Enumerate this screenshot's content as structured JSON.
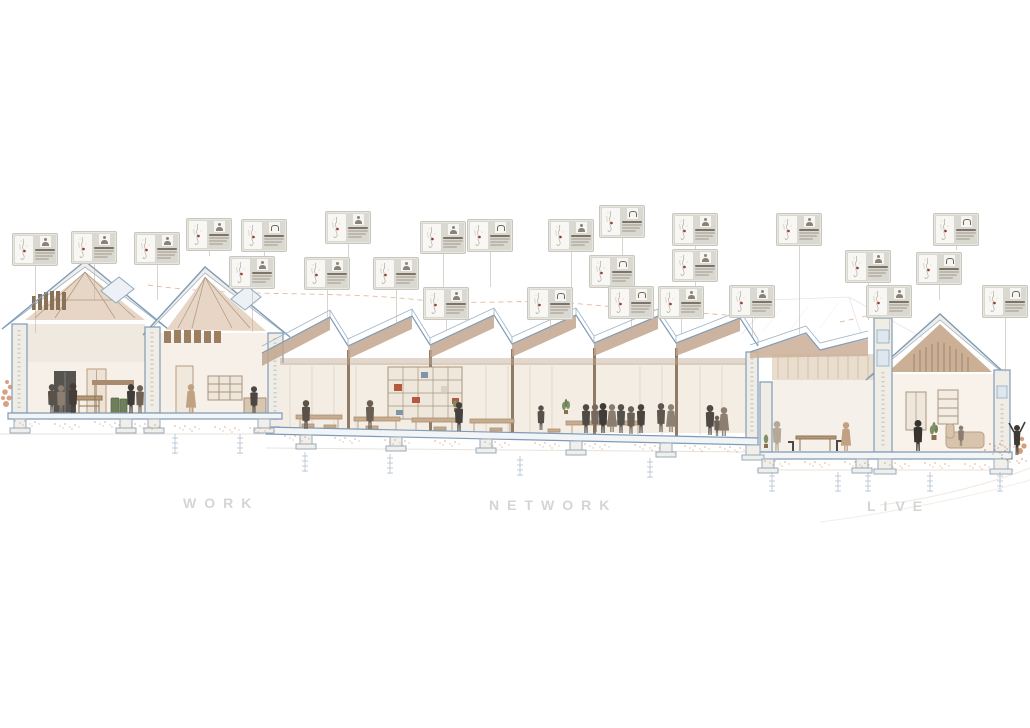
{
  "zones": [
    {
      "id": "work",
      "label": "WORK"
    },
    {
      "id": "network",
      "label": "NETWORK"
    },
    {
      "id": "live",
      "label": "LIVE"
    }
  ],
  "colors": {
    "section_cut_blue": "#7e9cb8",
    "framing_blue_light": "#9fb3c6",
    "roof_cream": "#f2eee7",
    "roof_underside_tan": "#c2a68f",
    "attic_timber": "#e7d6c5",
    "interior_wash": "#f6f0e9",
    "ground_hatch_orange": "#d08a62",
    "card_background": "#dad9d1",
    "card_map_marker_red": "#9c3a2c",
    "label_grey": "#d5d5d7",
    "figure_dark": "#45413d",
    "barrel_green": "#6d7f5b"
  },
  "cards": [
    {
      "x": 12,
      "y": 233,
      "icon": "person",
      "line_to": 333
    },
    {
      "x": 71,
      "y": 231,
      "icon": "person",
      "line_to": 300
    },
    {
      "x": 134,
      "y": 232,
      "icon": "person",
      "line_to": 300
    },
    {
      "x": 186,
      "y": 218,
      "icon": "person",
      "line_to": 256
    },
    {
      "x": 241,
      "y": 219,
      "icon": "object",
      "line_to": 256
    },
    {
      "x": 229,
      "y": 256,
      "icon": "person",
      "line_to": 332
    },
    {
      "x": 304,
      "y": 257,
      "icon": "person",
      "line_to": 330
    },
    {
      "x": 325,
      "y": 211,
      "icon": "person",
      "line_to": 257
    },
    {
      "x": 373,
      "y": 257,
      "icon": "person",
      "line_to": 330
    },
    {
      "x": 420,
      "y": 221,
      "icon": "person",
      "line_to": 287
    },
    {
      "x": 467,
      "y": 219,
      "icon": "object",
      "line_to": 287
    },
    {
      "x": 423,
      "y": 287,
      "icon": "person",
      "line_to": 330
    },
    {
      "x": 527,
      "y": 287,
      "icon": "object",
      "line_to": 332
    },
    {
      "x": 548,
      "y": 219,
      "icon": "person",
      "line_to": 287
    },
    {
      "x": 599,
      "y": 205,
      "icon": "object",
      "line_to": 255
    },
    {
      "x": 589,
      "y": 255,
      "icon": "object",
      "line_to": 286
    },
    {
      "x": 608,
      "y": 286,
      "icon": "object",
      "line_to": 334
    },
    {
      "x": 658,
      "y": 286,
      "icon": "person",
      "line_to": 334
    },
    {
      "x": 672,
      "y": 213,
      "icon": "person",
      "line_to": 249
    },
    {
      "x": 672,
      "y": 249,
      "icon": "person",
      "line_to": 286
    },
    {
      "x": 729,
      "y": 285,
      "icon": "person",
      "line_to": 336
    },
    {
      "x": 776,
      "y": 213,
      "icon": "person",
      "line_to": 334
    },
    {
      "x": 845,
      "y": 250,
      "icon": "person",
      "line_to": 320
    },
    {
      "x": 866,
      "y": 285,
      "icon": "person",
      "line_to": 340
    },
    {
      "x": 916,
      "y": 252,
      "icon": "object",
      "line_to": 300
    },
    {
      "x": 933,
      "y": 213,
      "icon": "object",
      "line_to": 250
    },
    {
      "x": 982,
      "y": 285,
      "icon": "object",
      "line_to": 372
    }
  ]
}
